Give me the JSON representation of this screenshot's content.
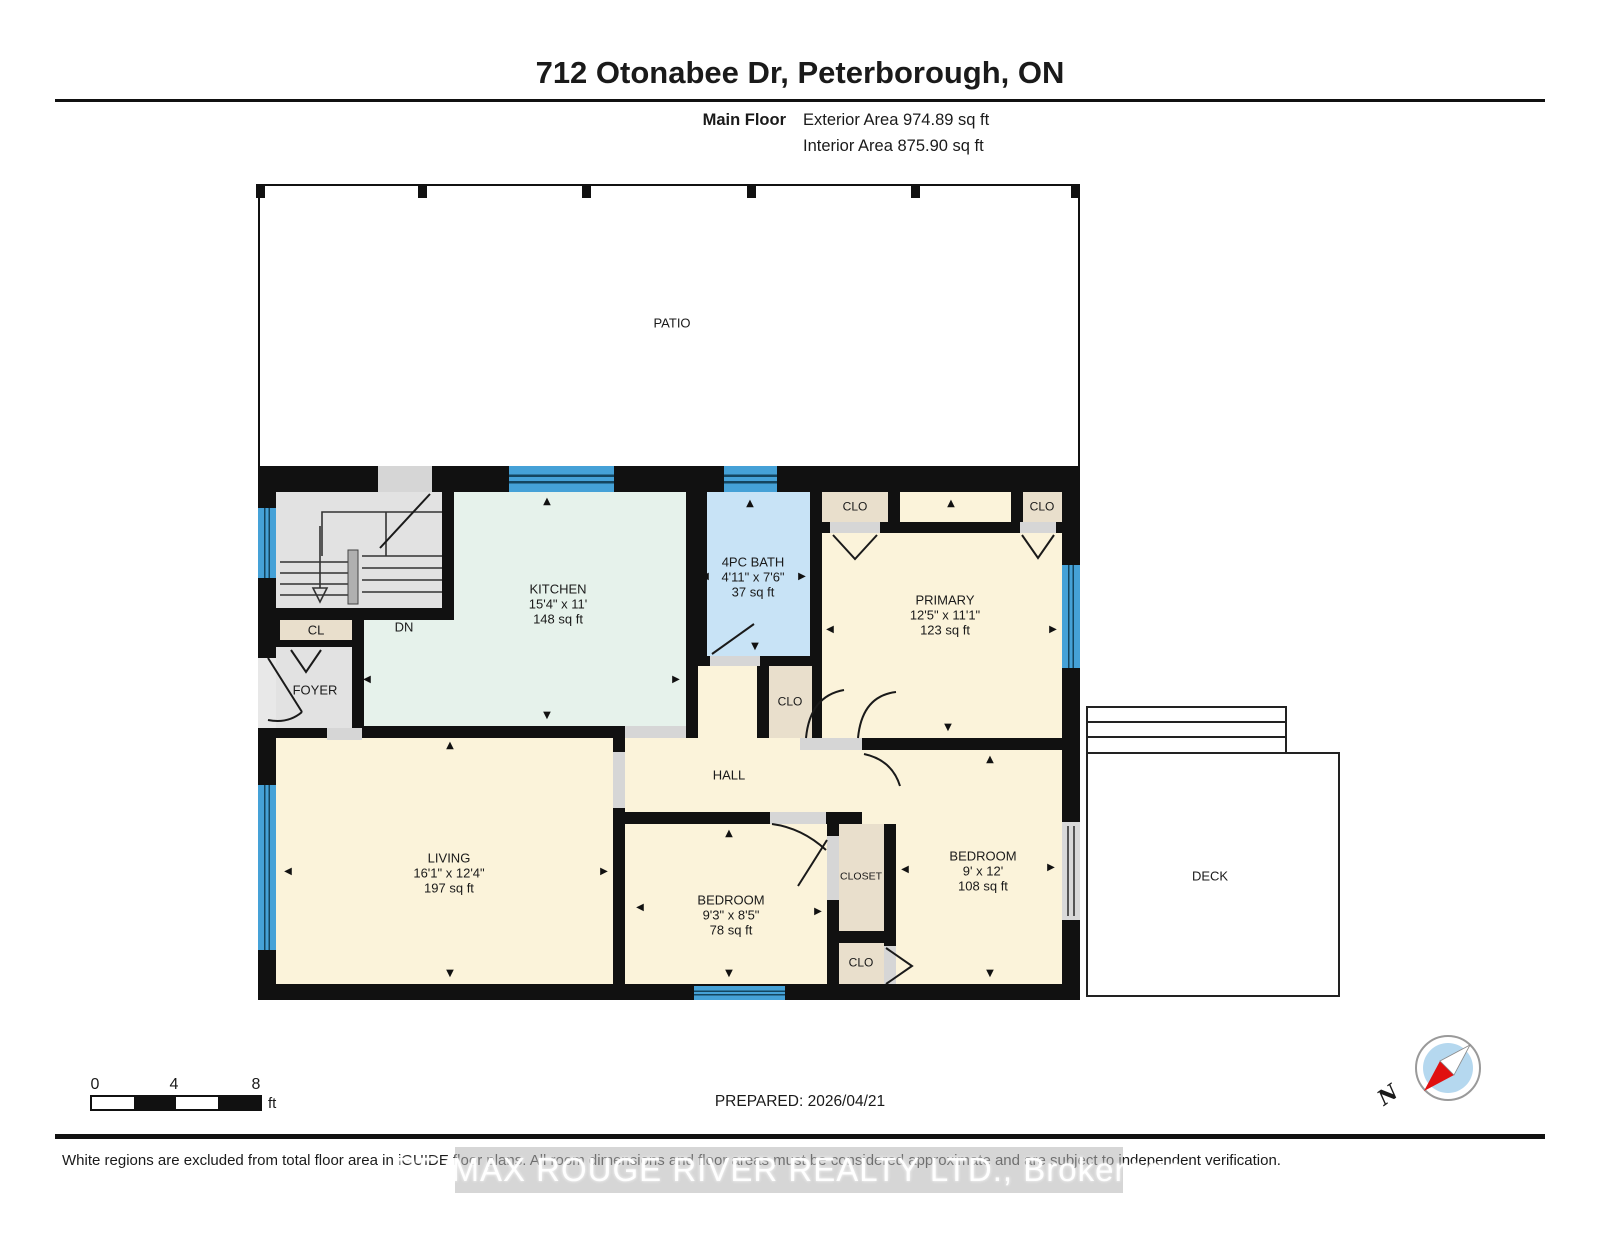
{
  "header": {
    "title": "712 Otonabee Dr, Peterborough, ON",
    "floor_label": "Main Floor",
    "exterior_area": "Exterior Area 974.89 sq ft",
    "interior_area": "Interior Area 875.90 sq ft"
  },
  "rooms": {
    "patio": {
      "name": "PATIO"
    },
    "kitchen": {
      "name": "KITCHEN",
      "dims": "15'4\" x 11'",
      "area": "148 sq ft"
    },
    "bath": {
      "name": "4PC BATH",
      "dims": "4'11\" x 7'6\"",
      "area": "37 sq ft"
    },
    "primary": {
      "name": "PRIMARY",
      "dims": "12'5\" x 11'1\"",
      "area": "123 sq ft"
    },
    "living": {
      "name": "LIVING",
      "dims": "16'1\" x 12'4\"",
      "area": "197 sq ft"
    },
    "bedroom_mid": {
      "name": "BEDROOM",
      "dims": "9'3\" x 8'5\"",
      "area": "78 sq ft"
    },
    "bedroom_right": {
      "name": "BEDROOM",
      "dims": "9' x 12'",
      "area": "108 sq ft"
    },
    "hall": {
      "name": "HALL"
    },
    "foyer": {
      "name": "FOYER"
    },
    "deck": {
      "name": "DECK"
    }
  },
  "labels": {
    "dn": "DN",
    "cl": "CL",
    "clo": "CLO",
    "closet": "CLOSET"
  },
  "scale_bar": {
    "start": "0",
    "mid": "4",
    "end": "8",
    "unit": "ft"
  },
  "footer": {
    "prepared": "PREPARED: 2026/04/21",
    "disclaimer": "White regions are excluded from total floor area in iGUIDE floor plans. All room dimensions and floor areas must be considered approximate and are subject to independent verification.",
    "watermark": "RE/MAX ROUGE RIVER REALTY LTD., Brokerage"
  },
  "compass": {
    "north": "N"
  },
  "colors": {
    "wall": "#111111",
    "window": "#45a1d7",
    "bath_fill": "#c8e3f6",
    "kitchen_fill": "#e6f2eb",
    "room_fill": "#fbf3da",
    "closet_fill": "#e9dfcc",
    "utility_fill": "#e2e2e2",
    "door_gap": "#d6d6d6",
    "compass_red": "#e01010",
    "compass_blue": "#b5d8ef"
  }
}
